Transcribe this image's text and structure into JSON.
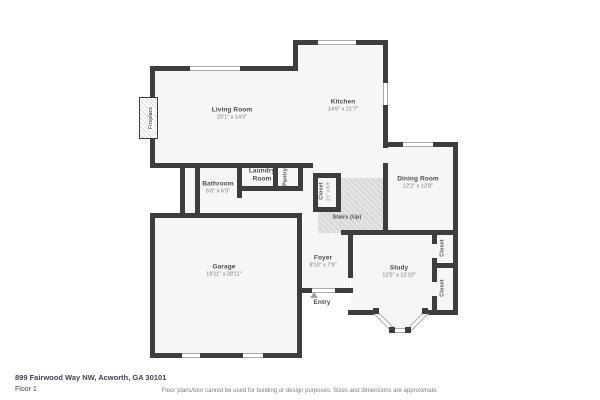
{
  "meta": {
    "address": "899 Fairwood Way NW, Acworth, GA 30101",
    "floor_label": "Floor 1",
    "disclaimer": "Floor plans/tour cannot be used for building or design purposes. Sizes and dimensions are approximate."
  },
  "rooms": {
    "living_room": {
      "name": "Living Room",
      "dims": "20'1\" x 14'3\""
    },
    "kitchen": {
      "name": "Kitchen",
      "dims": "14'6\" x 21'7\""
    },
    "bathroom": {
      "name": "Bathroom",
      "dims": "5'8\" x 6'3\""
    },
    "laundry_room": {
      "name": "Laundry Room"
    },
    "pantry": {
      "name": "Pantry"
    },
    "hall_closet": {
      "name": "Closet",
      "dims": "2'1\" x 6'3\""
    },
    "stairs": {
      "name": "Stairs (Up)"
    },
    "dining_room": {
      "name": "Dining Room",
      "dims": "12'2\" x 12'8\""
    },
    "garage": {
      "name": "Garage",
      "dims": "19'11\" x 28'11\""
    },
    "foyer": {
      "name": "Foyer",
      "dims": "8'10\" x 7'9\""
    },
    "entry": {
      "name": "Entry"
    },
    "study": {
      "name": "Study",
      "dims": "12'5\" x 13'10\""
    },
    "study_closet_top": {
      "name": "Closet"
    },
    "study_closet_bottom": {
      "name": "Closet"
    },
    "fireplace": {
      "name": "Fireplace"
    }
  },
  "colors": {
    "wall": "#3d3d3d",
    "room_fill": "#f6f6f6",
    "stairs_fill": "#e3e3e3",
    "room_label": "#4c4c4c",
    "dims_label": "#7a7a7a"
  }
}
